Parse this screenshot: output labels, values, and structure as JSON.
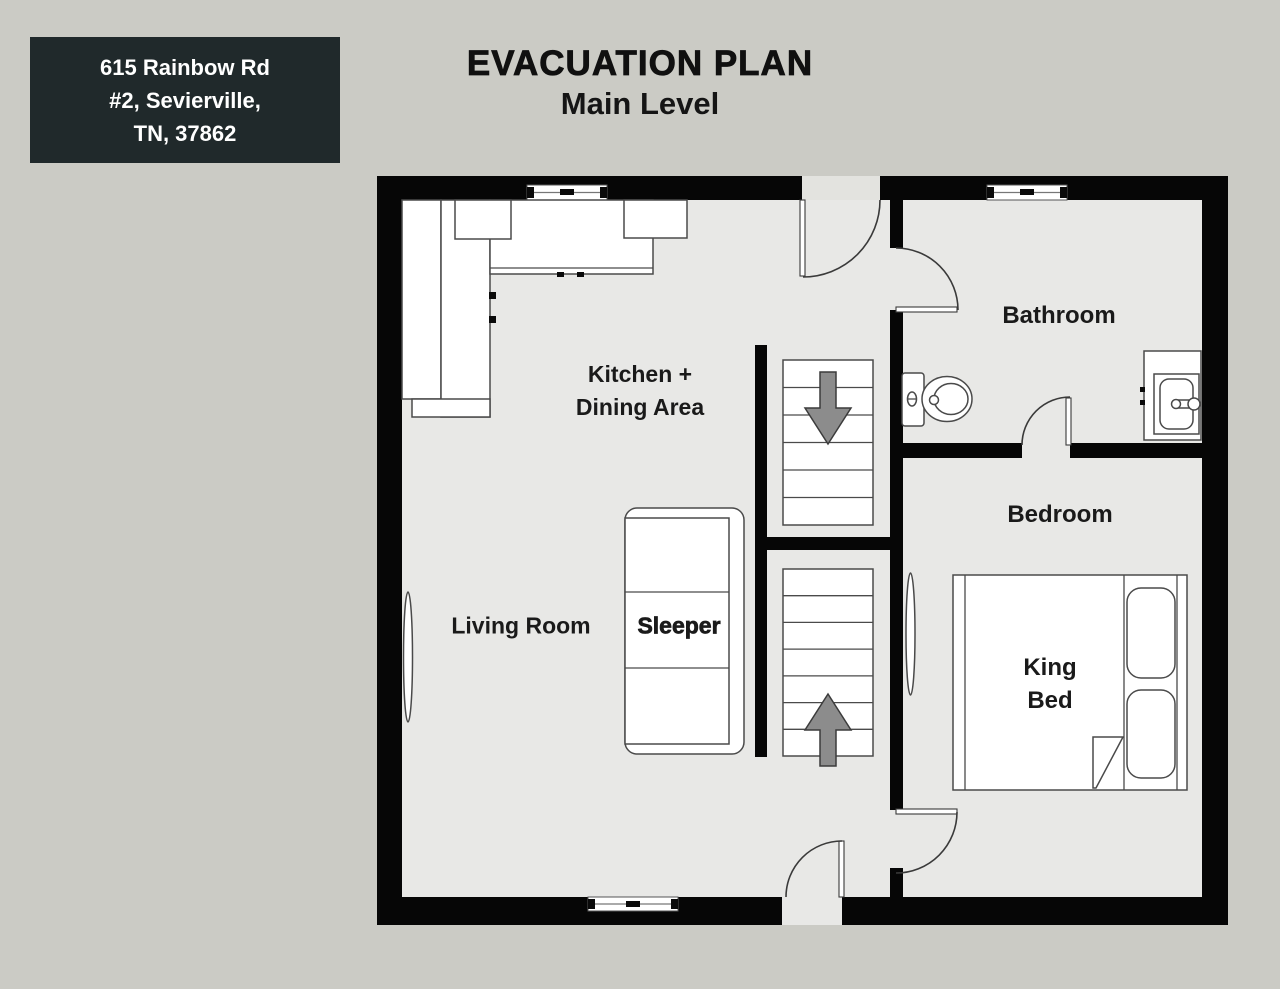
{
  "colors": {
    "background": "#cbcbc5",
    "floor": "#e8e8e6",
    "wall": "#060606",
    "outline": "#4a4a4a",
    "arrow": "#8c8c8c",
    "badge_bg": "#20292b",
    "badge_text": "#ffffff",
    "text": "#1a1a1a",
    "threshold": "#e3e3df"
  },
  "badge": {
    "lines": [
      "615 Rainbow Rd",
      "#2, Sevierville,",
      "TN, 37862"
    ]
  },
  "title": {
    "main": "EVACUATION PLAN",
    "subtitle": "Main Level"
  },
  "plan": {
    "rooms": {
      "kitchen": {
        "line1": "Kitchen +",
        "line2": "Dining Area"
      },
      "living": {
        "label": "Living Room"
      },
      "bathroom": {
        "label": "Bathroom"
      },
      "bedroom": {
        "label": "Bedroom"
      }
    },
    "furniture": {
      "sleeper": {
        "label": "Sleeper"
      },
      "king_bed": {
        "line1": "King",
        "line2": "Bed"
      }
    },
    "icons": {
      "down_arrow": "stairs going down",
      "up_arrow": "stairs going up",
      "toilet": "toilet fixture",
      "sink": "sink vanity",
      "window": "window symbol",
      "door": "door swing symbol"
    }
  }
}
